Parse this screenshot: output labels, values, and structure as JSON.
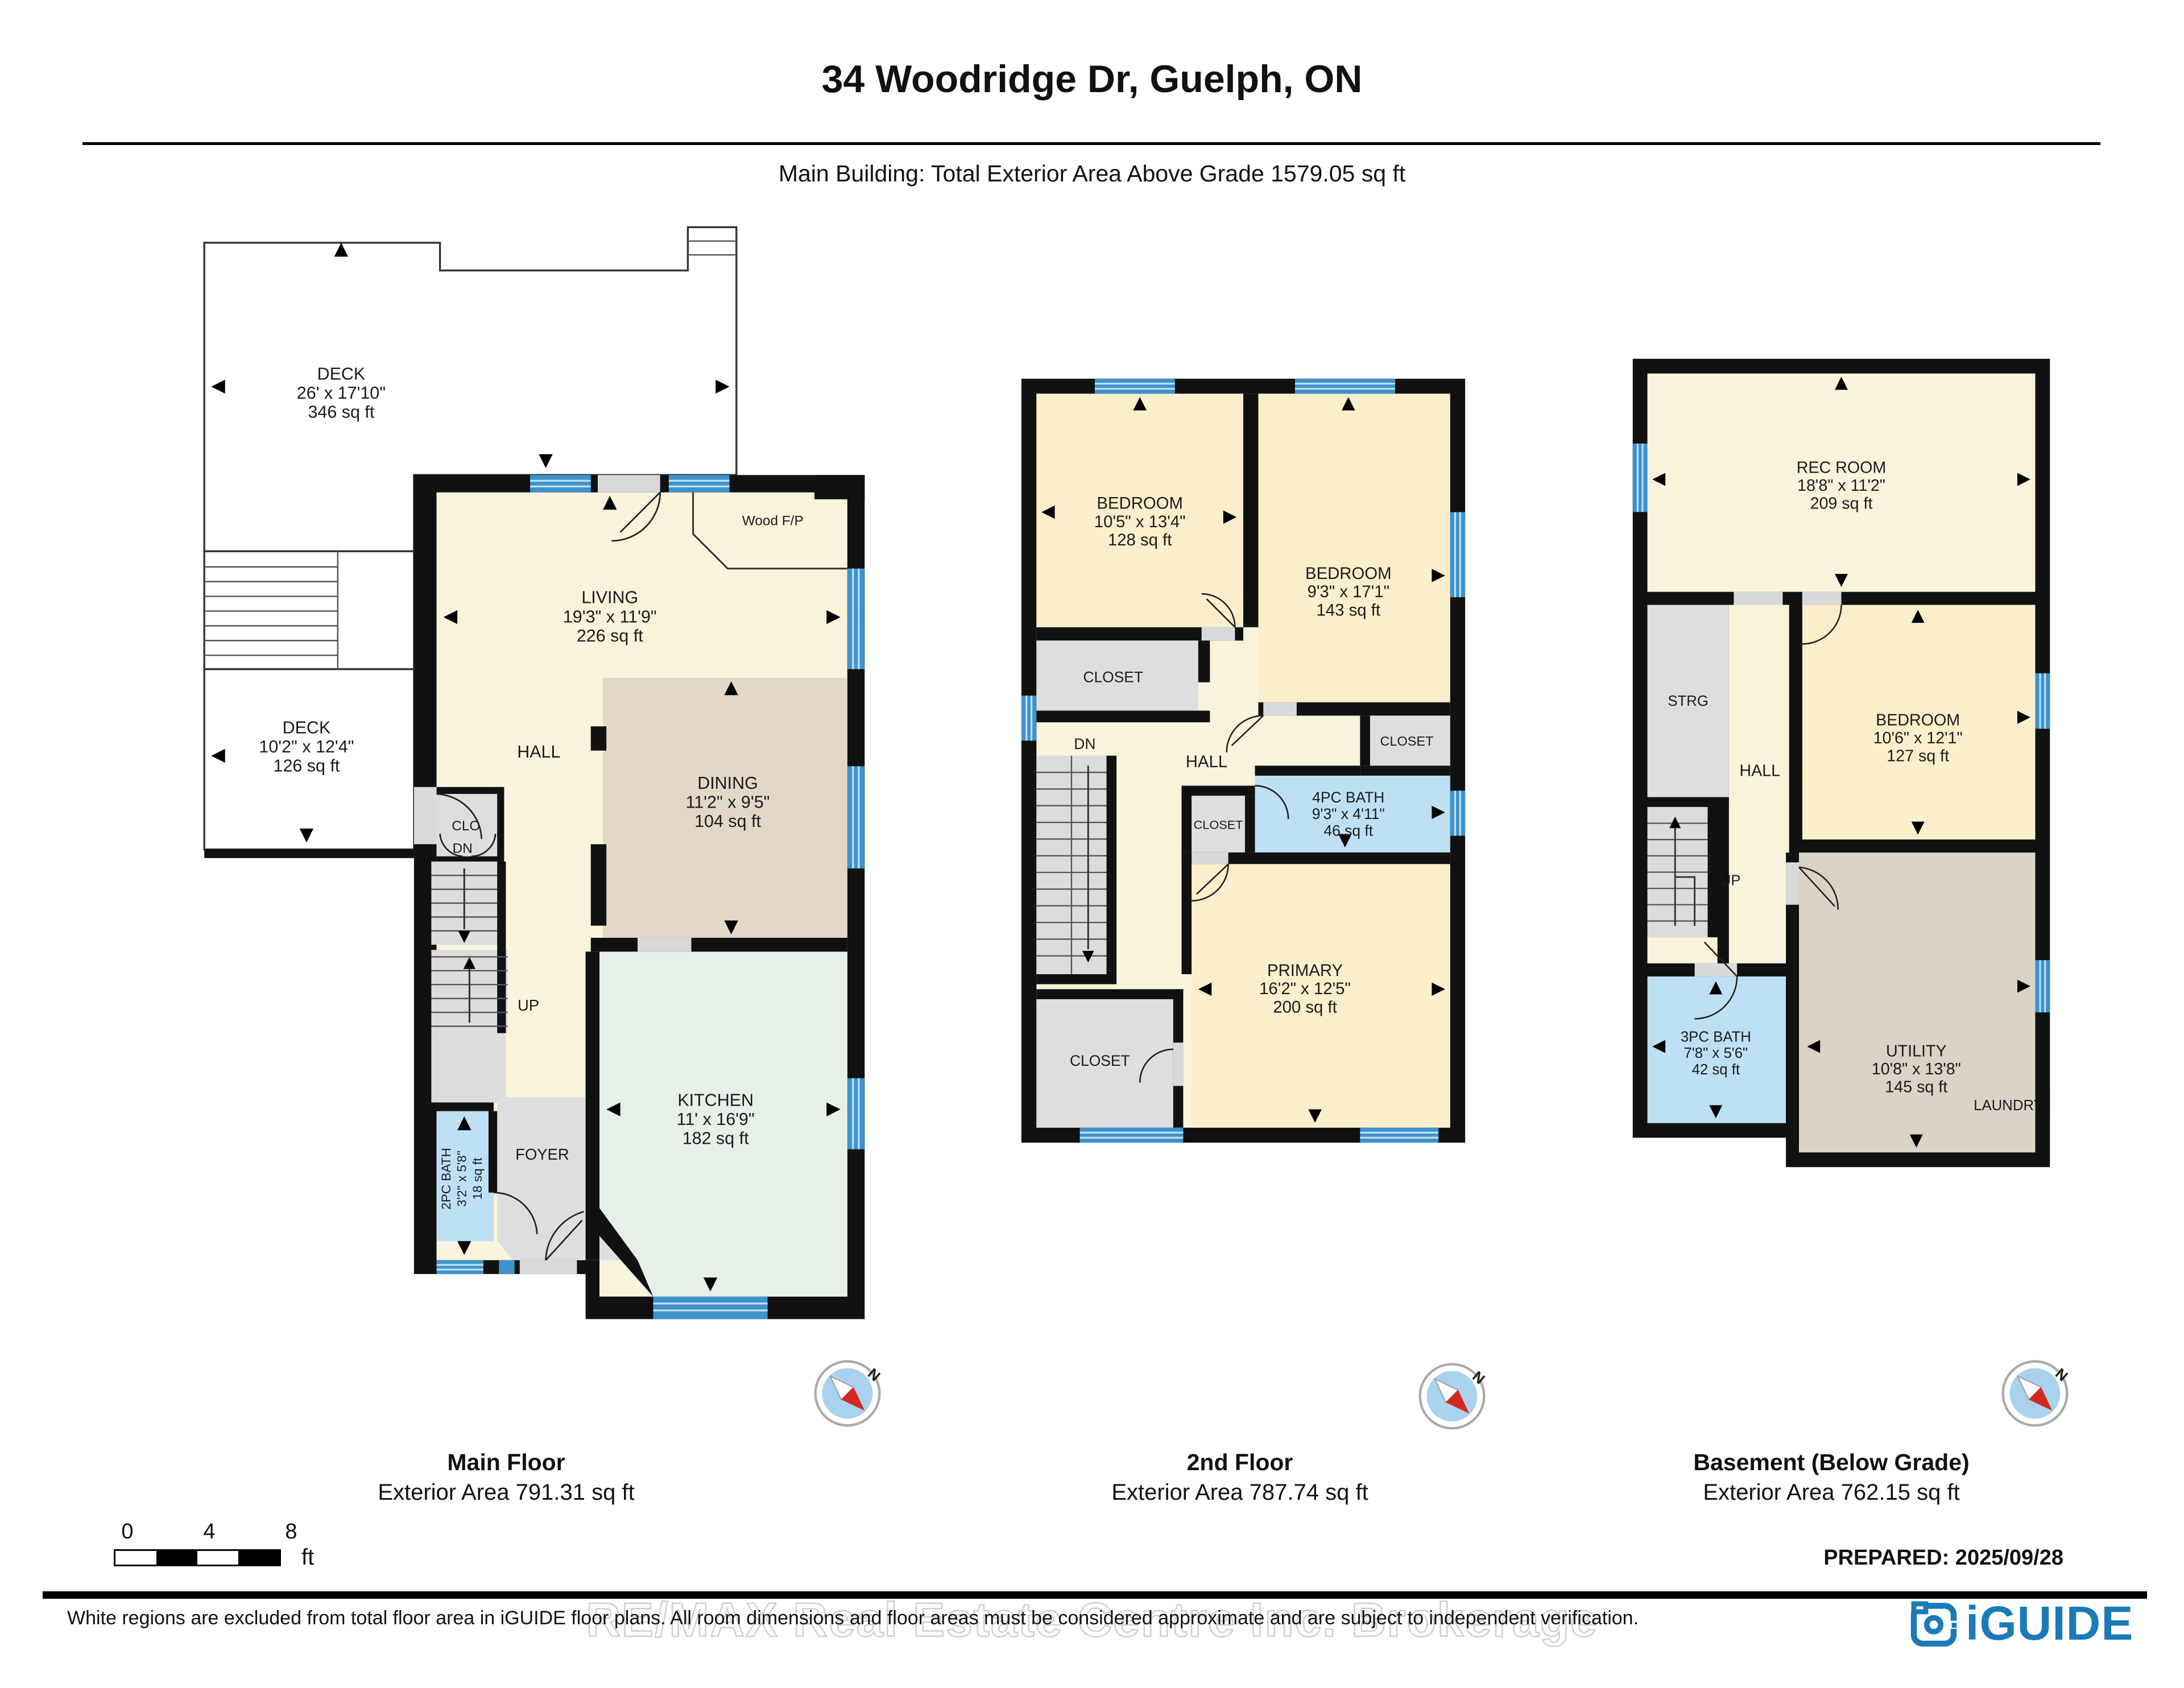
{
  "header": {
    "title": "34 Woodridge Dr, Guelph, ON",
    "subtitle": "Main Building: Total Exterior Area Above Grade 1579.05 sq ft"
  },
  "floors": [
    {
      "label": "Main Floor",
      "area_label": "Exterior Area 791.31 sq ft",
      "rooms": {
        "deck_upper": {
          "name": "DECK",
          "dims": "26' x 17'10\"",
          "area": "346 sq ft"
        },
        "deck_lower": {
          "name": "DECK",
          "dims": "10'2\" x 12'4\"",
          "area": "126 sq ft"
        },
        "living": {
          "name": "LIVING",
          "dims": "19'3\" x 11'9\"",
          "area": "226 sq ft"
        },
        "wood_fp": {
          "name": "Wood F/P"
        },
        "clo": {
          "name": "CLO"
        },
        "hall": {
          "name": "HALL"
        },
        "dn": {
          "name": "DN"
        },
        "up": {
          "name": "UP"
        },
        "dining": {
          "name": "DINING",
          "dims": "11'2\" x 9'5\"",
          "area": "104 sq ft"
        },
        "kitchen": {
          "name": "KITCHEN",
          "dims": "11' x 16'9\"",
          "area": "182 sq ft"
        },
        "bath": {
          "name": "2PC BATH",
          "dims": "3'2\" x 5'8\"",
          "area": "18 sq ft"
        },
        "foyer": {
          "name": "FOYER"
        }
      }
    },
    {
      "label": "2nd Floor",
      "area_label": "Exterior Area 787.74 sq ft",
      "rooms": {
        "bedroom_left": {
          "name": "BEDROOM",
          "dims": "10'5\" x 13'4\"",
          "area": "128 sq ft"
        },
        "bedroom_right": {
          "name": "BEDROOM",
          "dims": "9'3\" x 17'1\"",
          "area": "143 sq ft"
        },
        "closet_left": {
          "name": "CLOSET"
        },
        "closet_right": {
          "name": "CLOSET"
        },
        "closet_mid": {
          "name": "CLOSET"
        },
        "closet_primary": {
          "name": "CLOSET"
        },
        "hall": {
          "name": "HALL"
        },
        "dn": {
          "name": "DN"
        },
        "bath": {
          "name": "4PC BATH",
          "dims": "9'3\" x 4'11\"",
          "area": "46 sq ft"
        },
        "primary": {
          "name": "PRIMARY",
          "dims": "16'2\" x 12'5\"",
          "area": "200 sq ft"
        }
      }
    },
    {
      "label": "Basement (Below Grade)",
      "area_label": "Exterior Area 762.15 sq ft",
      "rooms": {
        "rec": {
          "name": "REC ROOM",
          "dims": "18'8\" x 11'2\"",
          "area": "209 sq ft"
        },
        "strg": {
          "name": "STRG"
        },
        "hall": {
          "name": "HALL"
        },
        "up": {
          "name": "UP"
        },
        "bedroom": {
          "name": "BEDROOM",
          "dims": "10'6\" x 12'1\"",
          "area": "127 sq ft"
        },
        "bath": {
          "name": "3PC BATH",
          "dims": "7'8\" x 5'6\"",
          "area": "42 sq ft"
        },
        "utility": {
          "name": "UTILITY",
          "dims": "10'8\" x 13'8\"",
          "area": "145 sq ft"
        },
        "laundry": {
          "name": "LAUNDRY"
        }
      }
    }
  ],
  "compass": {
    "n": "N"
  },
  "scale_bar": {
    "t0": "0",
    "t4": "4",
    "t8": "8",
    "unit": "ft"
  },
  "footer": {
    "prepared": "PREPARED: 2025/09/28",
    "disclaimer": "White regions are excluded from total floor area in iGUIDE floor plans. All room dimensions and floor areas must be considered approximate and are subject to independent verification.",
    "watermark": "RE/MAX Real Estate Centre Inc. Brokerage",
    "brand": "iGUIDE"
  },
  "colors": {
    "accent_blue": "#1B7AB8",
    "window_blue": "#3E92CC",
    "bath_blue": "#BEE0F5",
    "room_cream": "#FAF3DC",
    "room_yellow": "#FBEECB",
    "dining_tan": "#E3D8C8",
    "kitchen_green": "#E7EFE9",
    "gray_room": "#DEDEDE",
    "compass_red": "#D3281E"
  }
}
